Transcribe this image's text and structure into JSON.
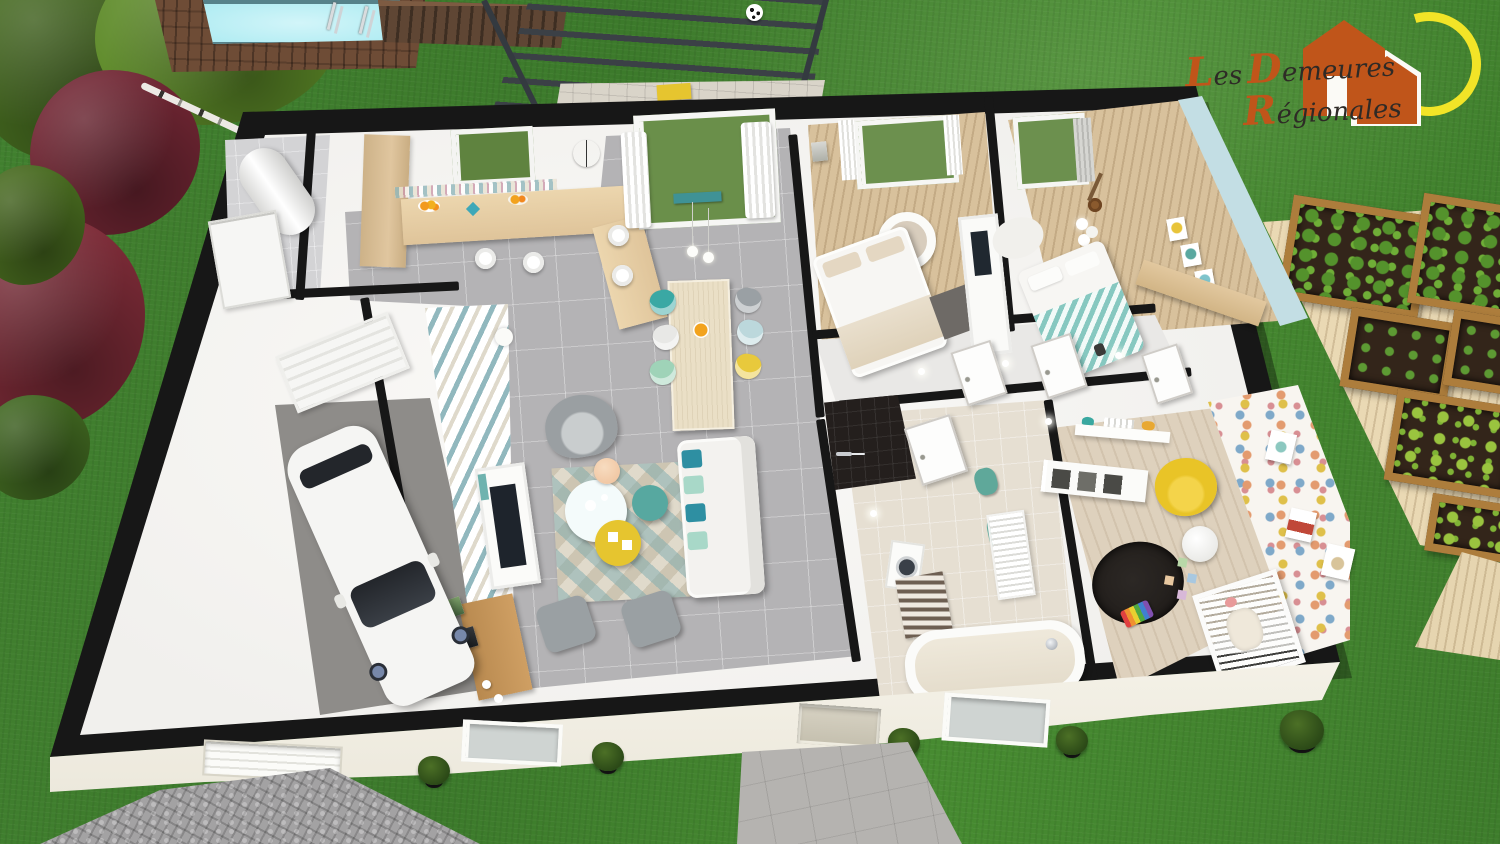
{
  "logo": {
    "words": [
      {
        "initial": "L",
        "rest": "es"
      },
      {
        "initial": "D",
        "rest": "emeures"
      },
      {
        "initial": "R",
        "rest": "égionales"
      }
    ]
  },
  "scene": {
    "description": "3D aerial cutaway floor plan render of a single-storey house with garden",
    "exterior_elements": [
      "lawn",
      "ornamental trees",
      "birch trunk",
      "swimming pool",
      "wooden pool deck",
      "two pool ladders",
      "wooden shed",
      "grey pergola over tiled patio",
      "soccer ball",
      "raised vegetable garden beds on light deck",
      "cobblestone driveway",
      "paved entrance path",
      "boxwood shrubs",
      "white front facade with sectional garage door, windows and entrance door"
    ],
    "rooms": [
      {
        "name": "utility-room",
        "items": [
          "water heater",
          "storage shelving"
        ]
      },
      {
        "name": "kitchen",
        "items": [
          "wooden bar counter",
          "four white bar stools",
          "wall clock",
          "window",
          "fruit bowls",
          "tall cabinet",
          "mosaic backsplash"
        ]
      },
      {
        "name": "dining-area",
        "items": [
          "wooden dining table",
          "six shell chairs (teal, grey, white, light-blue, mint, yellow)",
          "two pendant lights",
          "sliding glass door with white curtains",
          "teal garden bench outside"
        ]
      },
      {
        "name": "living-room",
        "items": [
          "white sofa with teal cushions",
          "grey armchair",
          "round nesting coffee tables (white, teal, yellow)",
          "geometric rug",
          "two grey poufs",
          "white TV unit",
          "wooden sideboard with leaning frames",
          "teal geometric accent wall",
          "peach pendant lamp"
        ]
      },
      {
        "name": "garage",
        "items": [
          "white car",
          "sectional garage door"
        ]
      },
      {
        "name": "master-bedroom",
        "items": [
          "double bed with beige throw",
          "round white pendant lamp",
          "window with curtains",
          "dark rug",
          "wall TV unit"
        ]
      },
      {
        "name": "bedroom-2",
        "items": [
          "bed with teal chevron throw",
          "guitar",
          "cascade chandelier",
          "three gallery frames",
          "light-wood dresser",
          "light blue walls"
        ]
      },
      {
        "name": "hallway",
        "items": [
          "three white doors",
          "ceiling spotlights"
        ]
      },
      {
        "name": "bathroom",
        "items": [
          "dark tiled walk-in shower",
          "bathtub with chrome faucet",
          "white towel radiator",
          "washing machine",
          "striped mat",
          "teal towels"
        ]
      },
      {
        "name": "nursery",
        "items": [
          "white crib",
          "yellow armchair",
          "round white floor lamp",
          "black round rug",
          "toy xylophone",
          "pastel toy blocks",
          "polka-dot wallpaper",
          "cube storage",
          "wall shelf with toys"
        ]
      }
    ]
  },
  "palette": {
    "grass": "#3d7b2c",
    "wall": "#171717",
    "interior": "#f1f0ed",
    "floor-tile": "#b4b3b5",
    "wood-floor": "#d8c19c",
    "deck-wood": "#6e4c36",
    "pool": "#a9eaf1",
    "light-deck": "#ead9b4",
    "pergola": "#3b4046",
    "logo-orange": "#c0551a",
    "logo-sun": "#f2e427",
    "logo-text": "#2e2a26",
    "accent-teal": "#4aa4a8",
    "accent-yellow": "#e6c52f",
    "sofa": "#f3f2ef",
    "rug-dark": "#221e1b",
    "bath-floor": "#e6dfd2",
    "concrete": "#8e8c89",
    "cobble": "#a3a2a3"
  }
}
